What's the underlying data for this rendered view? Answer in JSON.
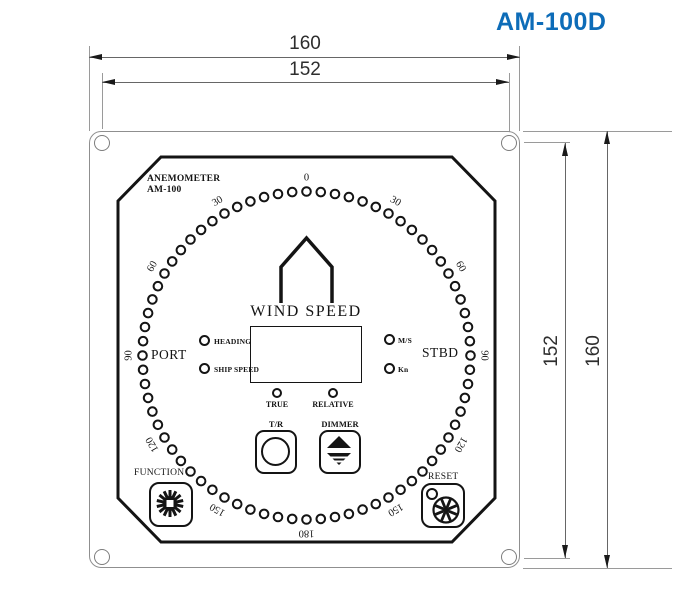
{
  "title": {
    "model": "AM-100D",
    "color": "#0d6cb8"
  },
  "dimensions": {
    "top_outer": "160",
    "top_inner": "152",
    "right_inner": "152",
    "right_outer": "160"
  },
  "panel": {
    "name_line1": "ANEMOMETER",
    "name_line2": "AM-100",
    "center_label": "WIND SPEED",
    "port_label": "PORT",
    "stbd_label": "STBD",
    "leds_left": [
      {
        "label": "HEADING"
      },
      {
        "label": "SHIP SPEED"
      }
    ],
    "leds_right": [
      {
        "label": "M/S"
      },
      {
        "label": "Kn"
      }
    ],
    "mode_indicators": [
      {
        "label": "TRUE"
      },
      {
        "label": "RELATIVE"
      }
    ],
    "buttons": [
      {
        "label": "T/R"
      },
      {
        "label": "DIMMER"
      }
    ],
    "knobs": [
      {
        "label": "FUNCTION"
      },
      {
        "label": "RESET"
      }
    ],
    "dial": {
      "dot_count": 72,
      "labels": [
        {
          "text": "0",
          "angle": 0
        },
        {
          "text": "30",
          "angle": 30
        },
        {
          "text": "60",
          "angle": 60
        },
        {
          "text": "90",
          "angle": 90
        },
        {
          "text": "120",
          "angle": 120
        },
        {
          "text": "150",
          "angle": 150
        },
        {
          "text": "180",
          "angle": 180
        },
        {
          "text": "150",
          "angle": -150
        },
        {
          "text": "120",
          "angle": -120
        },
        {
          "text": "90",
          "angle": -90
        },
        {
          "text": "60",
          "angle": -60
        },
        {
          "text": "30",
          "angle": -30
        }
      ]
    }
  }
}
